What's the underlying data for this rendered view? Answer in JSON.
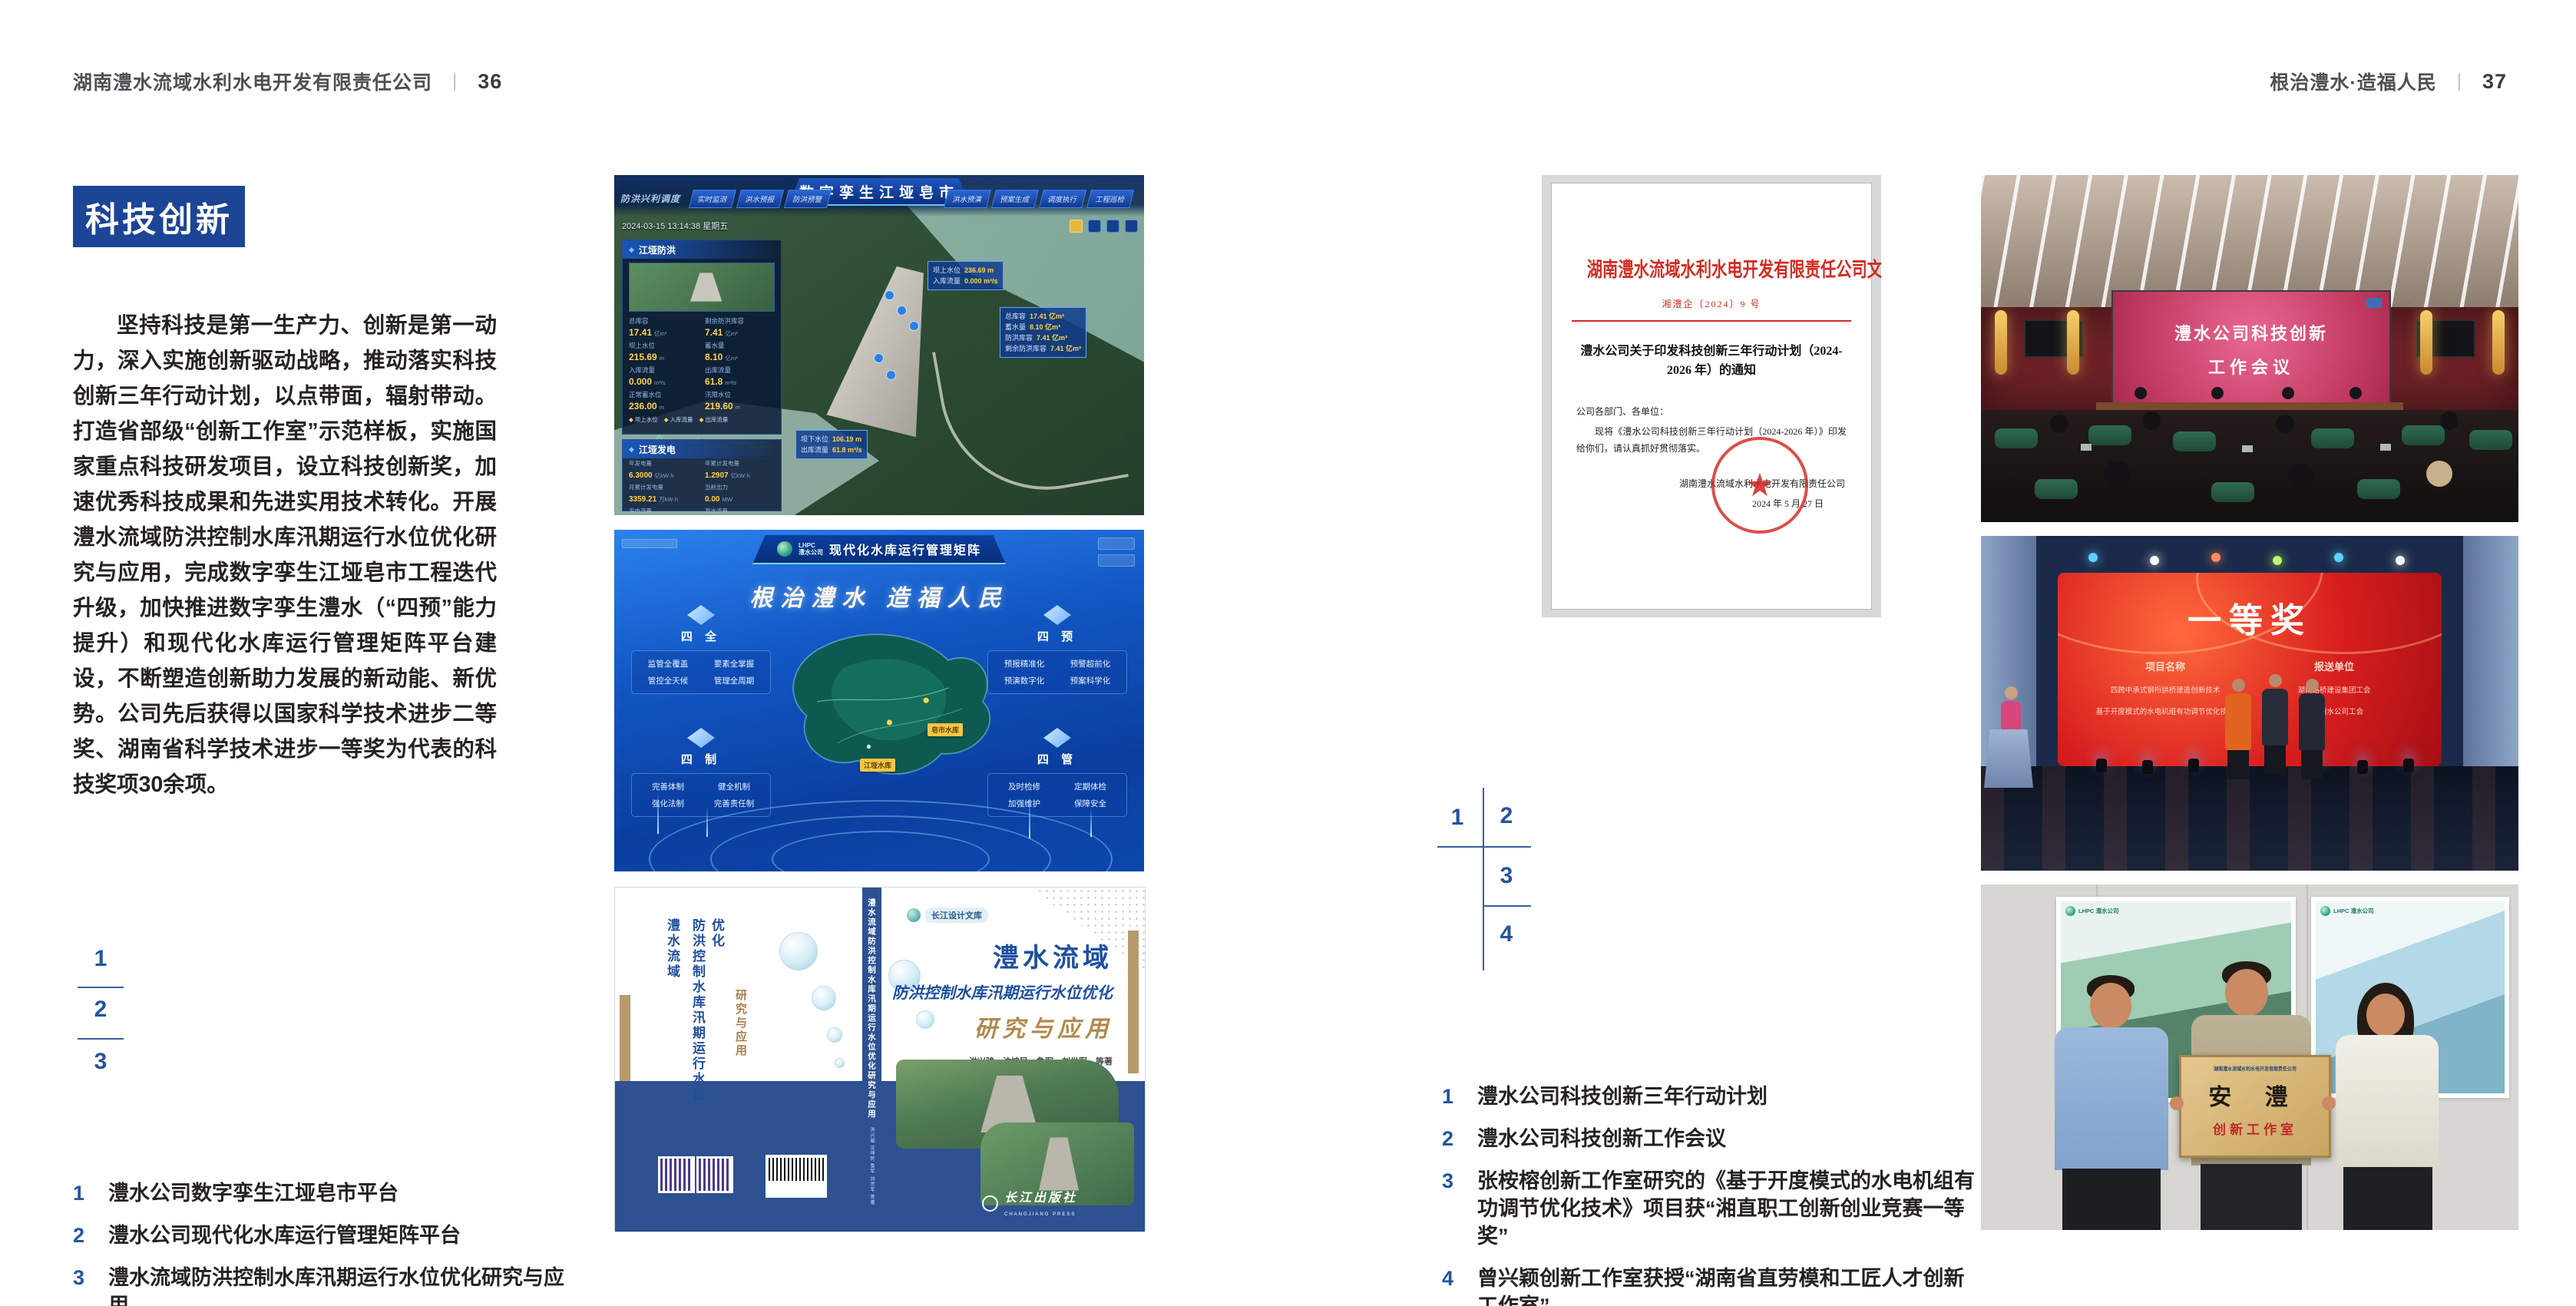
{
  "page_left": {
    "header": {
      "company": "湖南澧水流域水利水电开发有限责任公司",
      "divider": "|",
      "page_num": "36"
    },
    "section_badge": "科技创新",
    "body": "坚持科技是第一生产力、创新是第一动力，深入实施创新驱动战略，推动落实科技创新三年行动计划，以点带面，辐射带动。打造省部级“创新工作室”示范样板，实施国家重点科技研发项目，设立科技创新奖，加速优秀科技成果和先进实用技术转化。开展澧水流域防洪控制水库汛期运行水位优化研究与应用，完成数字孪生江垭皂市工程迭代升级，加快推进数字孪生澧水（“四预”能力提升）和现代化水库运行管理矩阵平台建设，不断塑造创新助力发展的新动能、新优势。公司先后获得以国家科学技术进步二等奖、湖南省科学技术进步一等奖为代表的科技奖项30余项。",
    "figure_index": {
      "n1": "1",
      "n2": "2",
      "n3": "3"
    },
    "captions": [
      {
        "num": "1",
        "text": "澧水公司数字孪生江垭皂市平台"
      },
      {
        "num": "2",
        "text": "澧水公司现代化水库运行管理矩阵平台"
      },
      {
        "num": "3",
        "text": "澧水流域防洪控制水库汛期运行水位优化研究与应用"
      }
    ]
  },
  "page_right": {
    "header": {
      "slogan": "根治澧水·造福人民",
      "divider": "|",
      "page_num": "37"
    },
    "figure_index": {
      "n1": "1",
      "n2": "2",
      "n3": "3",
      "n4": "4"
    },
    "captions": [
      {
        "num": "1",
        "text": "澧水公司科技创新三年行动计划"
      },
      {
        "num": "2",
        "text": "澧水公司科技创新工作会议"
      },
      {
        "num": "3",
        "text": "张桉榕创新工作室研究的《基于开度模式的水电机组有功调节优化技术》项目获“湘直职工创新创业竞赛一等奖”"
      },
      {
        "num": "4",
        "text": "曾兴颖创新工作室获授“湖南省直劳模和工匠人才创新工作室”"
      }
    ]
  },
  "dashboard": {
    "title": "数字孪生江垭皂市",
    "menu_label": "防洪兴利调度",
    "tabs_left": [
      "实时监测",
      "洪水预报",
      "防洪预警"
    ],
    "tabs_right": [
      "洪水预演",
      "预案生成",
      "调度执行",
      "工程巡检"
    ],
    "timestamp": "2024-03-15 13:14:38 星期五",
    "panel_flood": {
      "title": "江垭防洪",
      "stats": [
        {
          "label": "总库容",
          "value": "17.41",
          "unit": "亿m³"
        },
        {
          "label": "剩余防洪库容",
          "value": "7.41",
          "unit": "亿m³"
        },
        {
          "label": "坝上水位",
          "value": "215.69",
          "unit": "m"
        },
        {
          "label": "蓄水量",
          "value": "8.10",
          "unit": "亿m³"
        },
        {
          "label": "入库流量",
          "value": "0.000",
          "unit": "m³/s"
        },
        {
          "label": "出库流量",
          "value": "61.8",
          "unit": "m³/s"
        },
        {
          "label": "正常蓄水位",
          "value": "236.00",
          "unit": "m"
        },
        {
          "label": "汛限水位",
          "value": "219.60",
          "unit": "m"
        }
      ],
      "legend": [
        "坝上水位",
        "入库流量",
        "出库流量"
      ]
    },
    "panel_power": {
      "title": "江垭发电",
      "stats": [
        {
          "label": "年发电量",
          "value": "6.3000",
          "unit": "亿kW·h"
        },
        {
          "label": "年累计发电量",
          "value": "1.2907",
          "unit": "亿kW·h"
        },
        {
          "label": "月累计发电量",
          "value": "3359.21",
          "unit": "万kW·h"
        },
        {
          "label": "当前出力",
          "value": "0.00",
          "unit": "MW"
        },
        {
          "label": "发电流量",
          "value": "0.00",
          "unit": "m³/s"
        },
        {
          "label": "弃水流量",
          "value": "0.00",
          "unit": "m³/s"
        }
      ]
    },
    "callout_up": [
      {
        "label": "坝上水位",
        "value": "236.69 m"
      },
      {
        "label": "入库流量",
        "value": "0.000 m³/s"
      }
    ],
    "callout_cap": [
      {
        "label": "总库容",
        "value": "17.41 亿m³"
      },
      {
        "label": "蓄水量",
        "value": "8.10 亿m³"
      },
      {
        "label": "防洪库容",
        "value": "7.41 亿m³"
      },
      {
        "label": "剩余防洪库容",
        "value": "7.41 亿m³"
      }
    ],
    "callout_down": [
      {
        "label": "坝下水位",
        "value": "106.19 m"
      },
      {
        "label": "出库流量",
        "value": "61.8 m³/s"
      }
    ]
  },
  "matrix": {
    "logo_top": "LHPC",
    "logo_sub": "澧水公司",
    "title": "现代化水库运行管理矩阵",
    "slogan": "根治澧水 造福人民",
    "groups": [
      {
        "title": "四 全",
        "items": [
          "监管全覆盖",
          "要素全掌握",
          "管控全天候",
          "管理全周期"
        ]
      },
      {
        "title": "四 预",
        "items": [
          "预报精准化",
          "预警超前化",
          "预演数字化",
          "预案科学化"
        ]
      },
      {
        "title": "四 制",
        "items": [
          "完善体制",
          "健全机制",
          "强化法制",
          "完善责任制"
        ]
      },
      {
        "title": "四 管",
        "items": [
          "及时检修",
          "定期体检",
          "加强维护",
          "保障安全"
        ]
      }
    ],
    "map_labels": [
      "江垭水库",
      "皂市水库"
    ]
  },
  "book": {
    "series": "长江设计文库",
    "title1": "澧水流域",
    "title2": "防洪控制水库汛期运行水位优化",
    "title3": "研究与应用",
    "authors": "洪兴骏　沈坤民　鲁军　刘世军　等著",
    "spine": "澧水流域防洪控制水库汛期运行水位优化研究与应用",
    "spine_authors": "洪兴骏 沈坤民 鲁军 刘世军 等著",
    "publisher": "长江出版社",
    "publisher_en": "CHANGJIANG PRESS",
    "back_col1": "澧水流域",
    "back_col2": "防洪控制水库汛期运行水位优化",
    "back_col3": "研究与应用"
  },
  "document": {
    "header": "湖南澧水流域水利水电开发有限责任公司文件",
    "doc_no": "湘澧企〔2024〕9 号",
    "title": "澧水公司关于印发科技创新三年行动计划（2024-2026 年）的通知",
    "salutation": "公司各部门、各单位：",
    "body": "现将《澧水公司科技创新三年行动计划（2024-2026 年）》印发给你们，请认真抓好贯彻落实。",
    "signer": "湖南澧水流域水利水电开发有限责任公司",
    "date": "2024 年 5 月 27 日",
    "seal_star": "★"
  },
  "meeting": {
    "screen_line1": "澧水公司科技创新",
    "screen_line2": "工作会议"
  },
  "award": {
    "screen_title": "一等奖",
    "col1_header": "项目名称",
    "col2_header": "报送单位",
    "col1_rows": [
      "四跨中承式钢桁拱桥建造创新技术",
      "基于开度模式的水电机组有功调节优化技术"
    ],
    "col2_rows": [
      "湖南路桥建设集团工会",
      "湖南澧水公司工会"
    ]
  },
  "plaque": {
    "header": "湖南澧水流域水利水电开发有限责任公司",
    "main": "安 澧",
    "sub": "创新工作室",
    "poster_logo": "LHPC 澧水公司"
  },
  "glyphs": {
    "diamond": "◆",
    "star": "★"
  }
}
